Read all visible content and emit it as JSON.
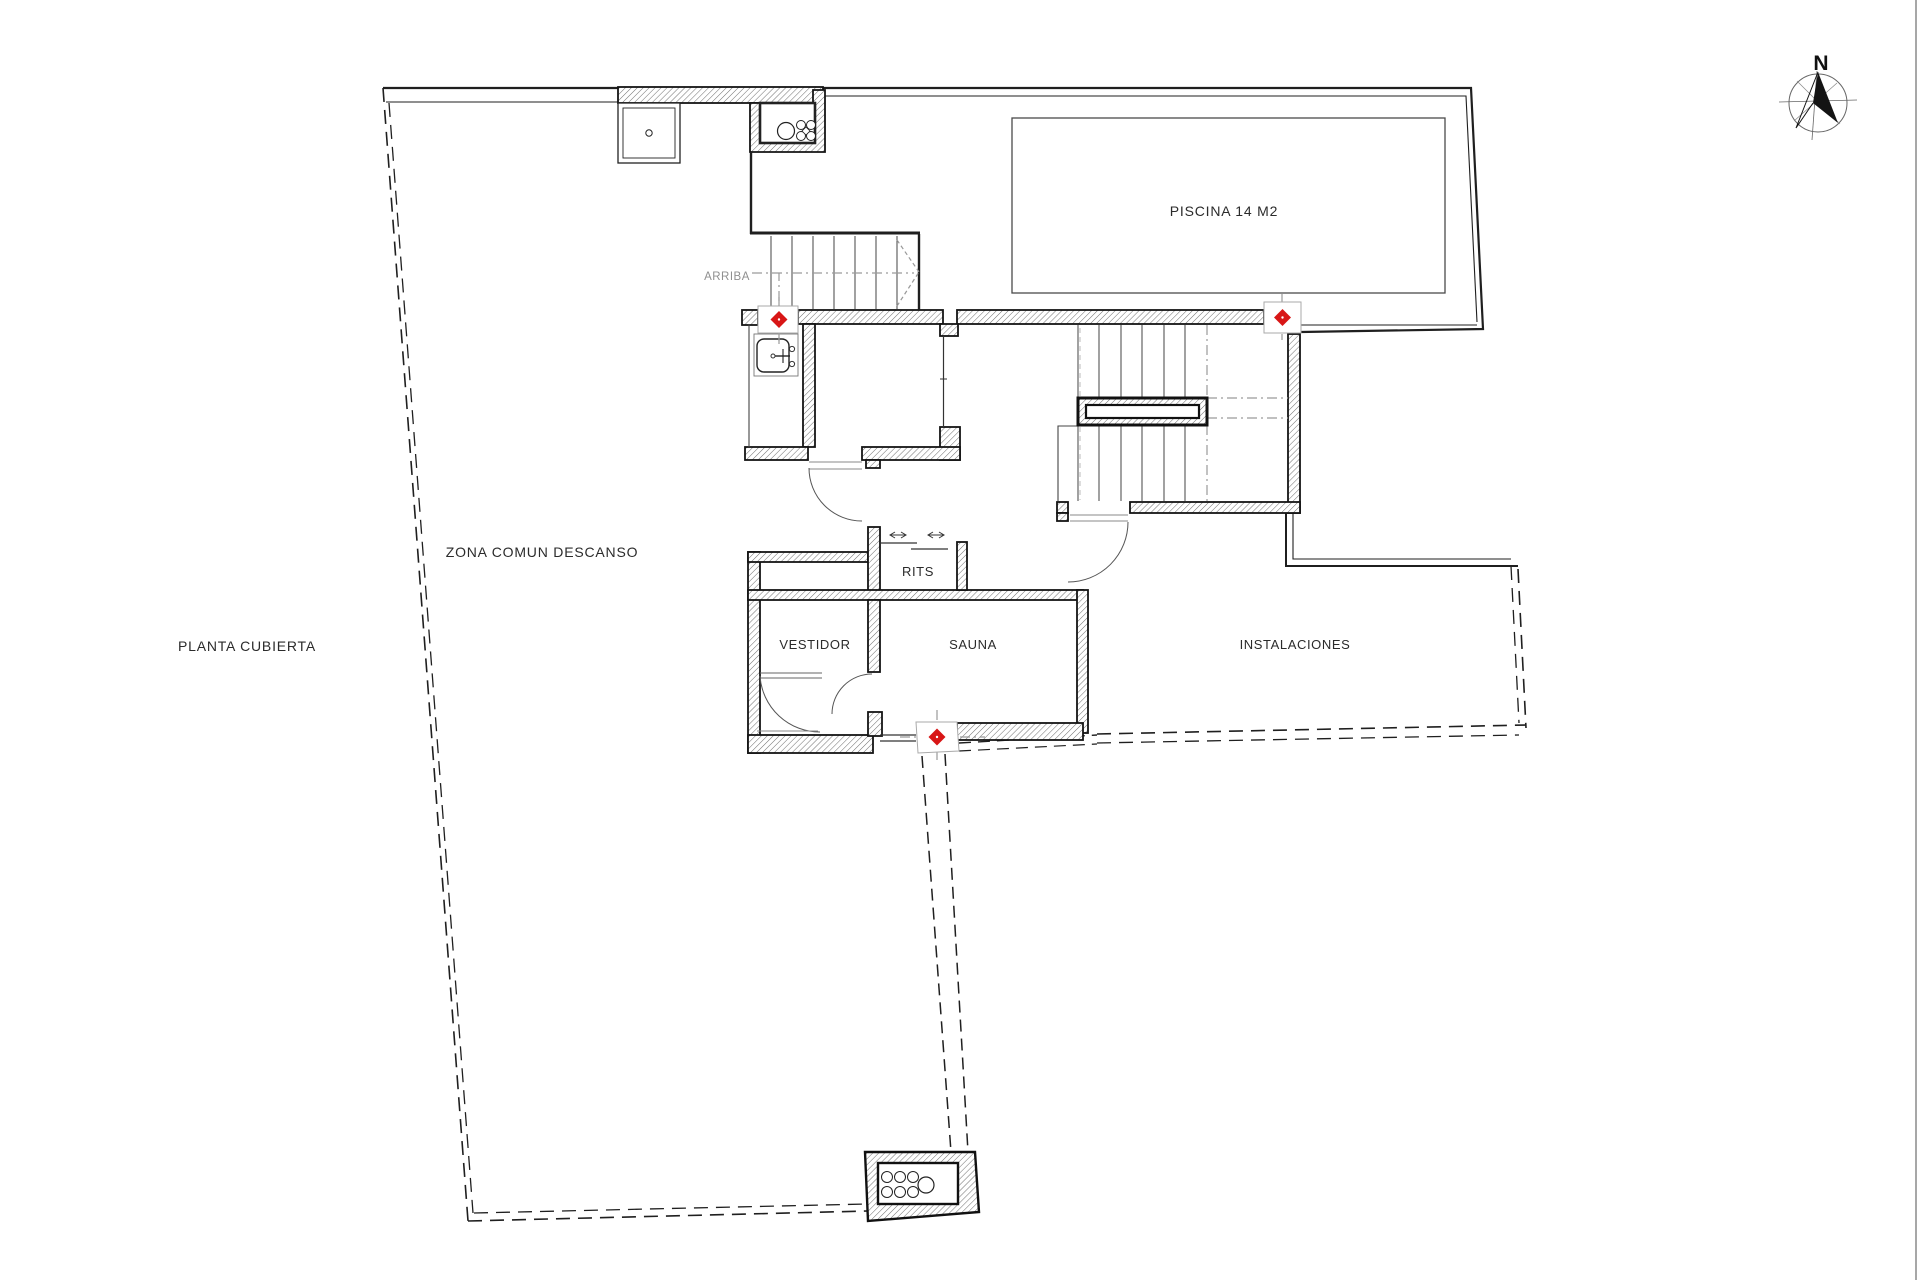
{
  "plan": {
    "title": "PLANTA CUBIERTA",
    "rooms": {
      "zona_comun": "ZONA COMUN DESCANSO",
      "piscina": "PISCINA 14 M2",
      "rits": "RITS",
      "vestidor": "VESTIDOR",
      "sauna": "SAUNA",
      "instalaciones": "INSTALACIONES"
    },
    "annotations": {
      "arriba": "ARRIBA",
      "north": "N"
    },
    "colors": {
      "marker_red": "#d81616",
      "line_dark": "#1a1a1a",
      "line_gray": "#8c8c8c"
    }
  }
}
